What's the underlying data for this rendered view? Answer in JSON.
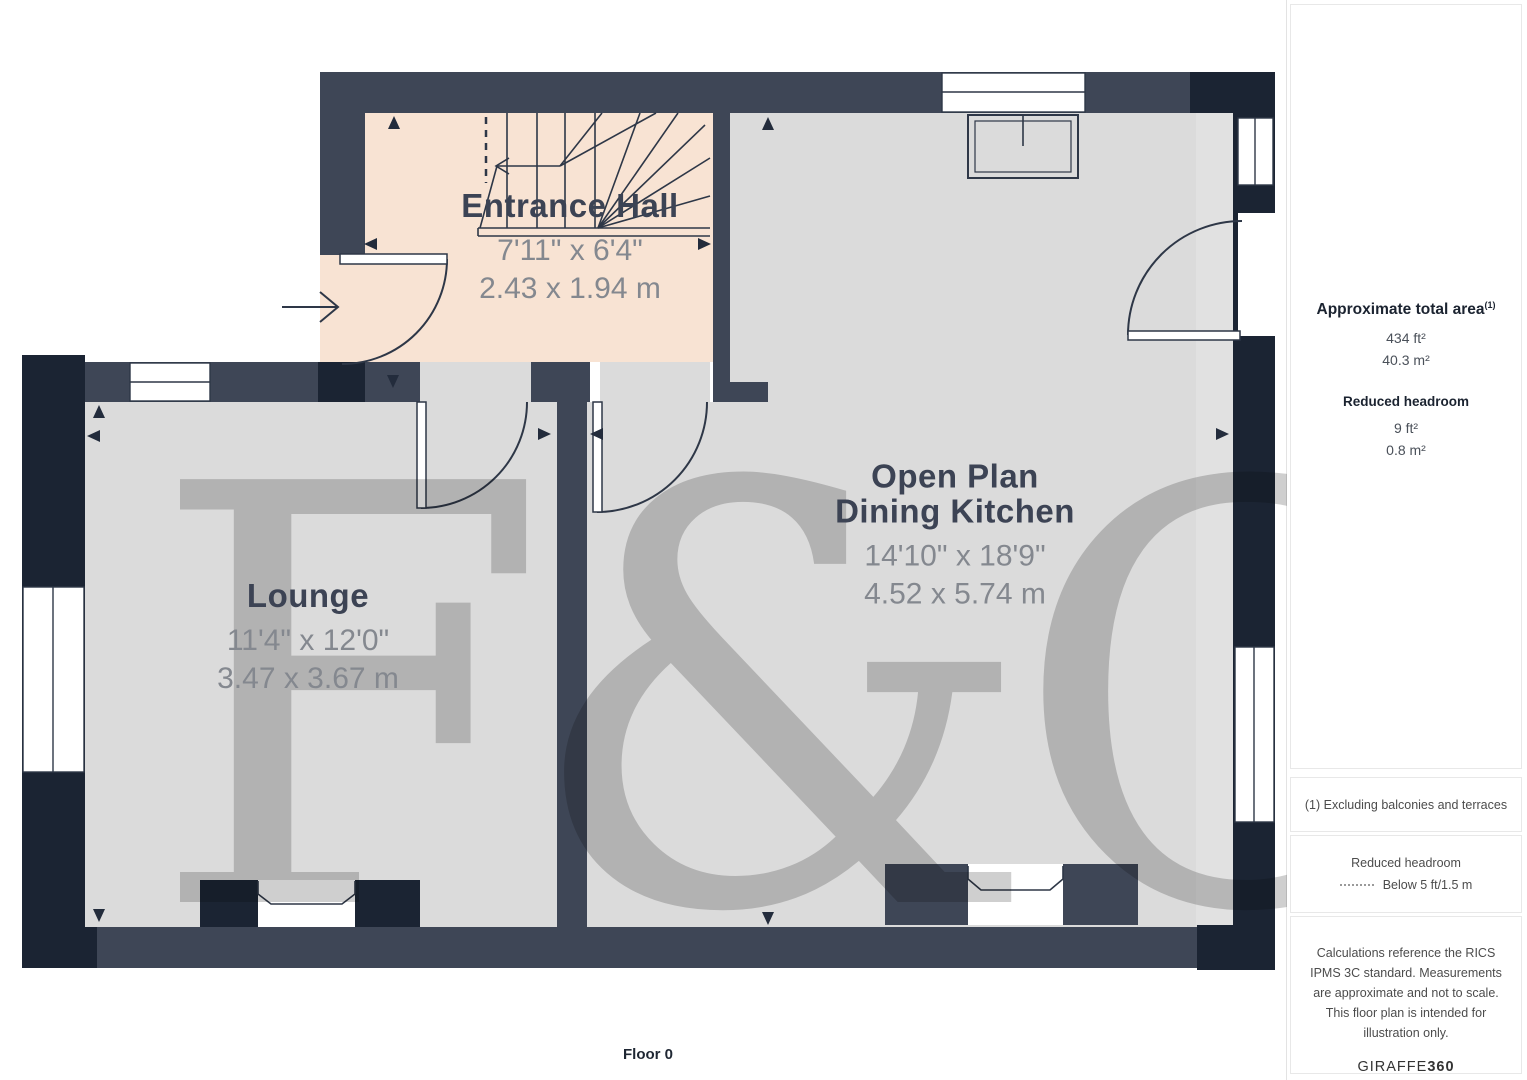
{
  "plan": {
    "floor_label": "Floor 0",
    "watermark": "F&C",
    "rooms": [
      {
        "id": "entrance-hall",
        "label": "Entrance Hall",
        "dim_imperial": "7'11\" x 6'4\"",
        "dim_metric": "2.43 x 1.94 m"
      },
      {
        "id": "lounge",
        "label": "Lounge",
        "dim_imperial": "11'4\" x 12'0\"",
        "dim_metric": "3.47 x 3.67 m"
      },
      {
        "id": "open-plan-dining-kitchen",
        "label_line1": "Open Plan",
        "label_line2": "Dining Kitchen",
        "dim_imperial": "14'10\" x 18'9\"",
        "dim_metric": "4.52 x 5.74 m"
      }
    ]
  },
  "sidebar": {
    "total_area": {
      "title": "Approximate total area",
      "superscript": "(1)",
      "value_ft": "434 ft²",
      "value_m": "40.3 m²"
    },
    "reduced_headroom": {
      "title": "Reduced headroom",
      "value_ft": "9 ft²",
      "value_m": "0.8 m²"
    },
    "note_exclusion": "(1) Excluding balconies and terraces",
    "legend": {
      "title": "Reduced headroom",
      "label": "Below 5 ft/1.5 m"
    },
    "disclaimer": "Calculations reference the RICS IPMS 3C standard. Measurements are approximate and not to scale. This floor plan is intended for illustration only.",
    "brand": {
      "name": "GIRAFFE",
      "suffix": "360"
    }
  },
  "colors": {
    "wall_slate": "#3E4656",
    "wall_navy": "#1B2433",
    "floor": "#DBDBDB",
    "floor_entrance_hall": "#F8E3D3",
    "plan_line": "#2E3747",
    "dim_text": "#84888F",
    "label_text": "#3C4354"
  }
}
